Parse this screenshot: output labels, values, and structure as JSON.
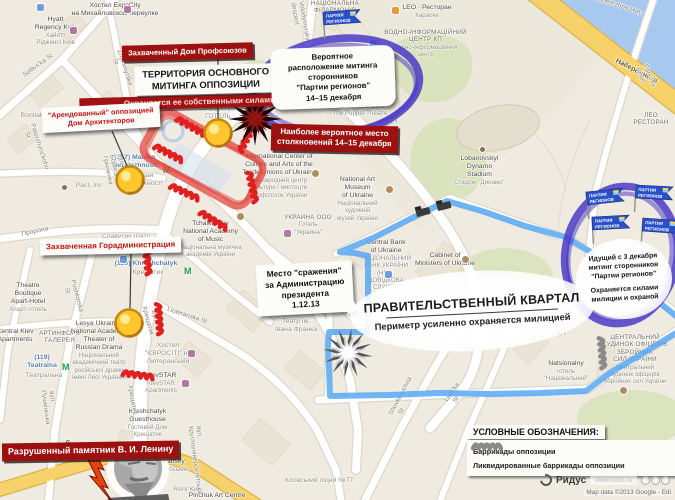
{
  "colors": {
    "barricade_red": "#e02020",
    "barricade_gray": "#8a8a8a",
    "perimeter_blue": "#58a8f4",
    "opposition_zone_red": "#e14038",
    "regions_purple": "#4633c6",
    "flag_blue": "#2a50c8",
    "marker_yellow": "#ffc62e",
    "callout_red_bg": "#9c1110",
    "road_yellow": "#f7d169",
    "water_blue": "#a7c9f0"
  },
  "annotations": {
    "boxes": {
      "trade_union": {
        "text": "Захваченный Дом Профсоюзов"
      },
      "territory": {
        "title_lines": [
          "ТЕРРИТОРИЯ ОСНОВНОГО",
          "МИТИНГА ОППОЗИЦИИ"
        ],
        "sub": "Охраняется ее собственными силами"
      },
      "architects": {
        "lines": [
          "\"Арендованный\" оппозицией",
          "Дом Архитекторов"
        ]
      },
      "rally_probable": {
        "lines": [
          "Вероятное",
          "расположение митинга",
          "сторонников",
          "\"Партии регионов\"",
          "14–15 декабря"
        ]
      },
      "clashes": {
        "lines": [
          "Наиболее вероятное место",
          "столкновений 14–15 декабря"
        ]
      },
      "city_admin": {
        "text": "Захваченная Горадминистрация"
      },
      "battle": {
        "lines": [
          "Место \"сражения\"",
          "за Администрацию",
          "президента",
          "1.12.13"
        ]
      },
      "gov_quarter": {
        "title": "ПРАВИТЕЛЬСТВЕННЫЙ КВАРТАЛ",
        "subtitle": "Периметр усиленно охраняется милицией"
      },
      "regions_rally": {
        "lines": [
          "Идущий с 3 декабря",
          "митинг сторонников",
          "\"Партии регионов\""
        ],
        "sub_lines": [
          "Охраняется силами",
          "милиции и охраной"
        ]
      },
      "lenin": {
        "text": "Разрушенный памятник В. И. Ленину"
      }
    },
    "legend": {
      "title": "УСЛОВНЫЕ ОБОЗНАЧЕНИЯ:",
      "items": [
        {
          "label": "Баррикады оппозиции",
          "color": "#e02020"
        },
        {
          "label": "Ликвидированные баррикады оппозиции",
          "color": "#8a8a8a"
        }
      ]
    },
    "flags_label": "ПАРТИЯ РЕГИОНОВ",
    "flags": [
      {
        "x": 323,
        "y": 12,
        "r": -4
      },
      {
        "x": 586,
        "y": 192,
        "r": -6
      },
      {
        "x": 636,
        "y": 185,
        "r": 3
      },
      {
        "x": 592,
        "y": 217,
        "r": -3
      },
      {
        "x": 643,
        "y": 218,
        "r": 4
      }
    ],
    "markers": [
      {
        "x": 218,
        "y": 133
      },
      {
        "x": 130,
        "y": 180
      },
      {
        "x": 129,
        "y": 323
      }
    ],
    "leaders": [
      [
        218,
        59,
        218,
        120
      ],
      [
        112,
        131,
        128,
        168
      ],
      [
        131,
        254,
        130,
        310
      ]
    ],
    "barricades_red": [
      {
        "x": 190,
        "y": 125,
        "r": 30
      },
      {
        "x": 168,
        "y": 152,
        "r": 28
      },
      {
        "x": 184,
        "y": 191,
        "r": 25
      },
      {
        "x": 213,
        "y": 219,
        "r": 32
      },
      {
        "x": 246,
        "y": 138,
        "r": -62
      },
      {
        "x": 253,
        "y": 186,
        "r": 78
      },
      {
        "x": 148,
        "y": 258,
        "r": 84
      },
      {
        "x": 160,
        "y": 318,
        "r": 86
      },
      {
        "x": 137,
        "y": 374,
        "r": 8
      }
    ],
    "barricades_gray": [
      {
        "x": 603,
        "y": 352,
        "r": 85
      }
    ],
    "vehicles": [
      {
        "x": 423,
        "y": 212,
        "r": -14
      },
      {
        "x": 444,
        "y": 206,
        "r": -14
      }
    ],
    "starbursts": [
      {
        "x": 255,
        "y": 119,
        "k": "dark"
      },
      {
        "x": 348,
        "y": 353,
        "k": "light"
      }
    ]
  },
  "map_labels": [
    {
      "x": 60,
      "y": 2,
      "w": 110,
      "cls": "p",
      "t": [
        "Хостел ExpoCity",
        "на Михайловском переулке"
      ]
    },
    {
      "x": 18,
      "y": 16,
      "w": 75,
      "cls": "p",
      "t": [
        "Hyatt",
        "Regency Kyiv"
      ],
      "s": [
        "Хайятт",
        "Рідженсі Київ"
      ]
    },
    {
      "x": 8,
      "y": 62,
      "w": 60,
      "cls": "st",
      "rot": -36,
      "t": [
        "Sofiivs'ka St"
      ]
    },
    {
      "x": 112,
      "y": 48,
      "w": 20,
      "cls": "st",
      "rot": 72,
      "t": [
        "Mala Zhytomyrska St"
      ]
    },
    {
      "x": 290,
      "y": 2,
      "w": 16,
      "cls": "st",
      "rot": 80,
      "t": [
        "Volodymyrskyi descent"
      ]
    },
    {
      "x": 305,
      "y": 0,
      "w": 60,
      "cls": "caps",
      "t": [
        "НАЦІОНАЛЬНА",
        "ФІЛАРМОНІЯ"
      ]
    },
    {
      "x": 398,
      "y": 4,
      "w": 58,
      "cls": "p",
      "t": [
        "LEO · Ресторан"
      ],
      "s": [
        "Караоке"
      ]
    },
    {
      "x": 378,
      "y": 29,
      "w": 95,
      "cls": "caps",
      "t": [
        "ВОДНО-ІНФОРМАЦІЙНИЙ",
        "ЦЕНТР КП"
      ],
      "s": [
        "Водно-інформаційний",
        "центр"
      ]
    },
    {
      "x": 588,
      "y": 2,
      "w": 60,
      "cls": "st",
      "rot": 18,
      "t": [
        "Naberezhne Hwy"
      ]
    },
    {
      "x": 606,
      "y": 68,
      "w": 62,
      "cls": "sty",
      "rot": 27,
      "t": [
        "Набережне ш."
      ]
    },
    {
      "x": 636,
      "y": 66,
      "w": 16,
      "cls": "st",
      "rot": 68,
      "t": [
        "Parkova Road"
      ]
    },
    {
      "x": 626,
      "y": 112,
      "w": 50,
      "cls": "caps",
      "t": [
        "ЛЕО",
        "РЕСТОРАН"
      ]
    },
    {
      "x": 325,
      "y": 88,
      "w": 70,
      "cls": "caps",
      "t": [
        "КИЇВСЬКИЙ",
        "АКАДЕМІЧНИЙ",
        "ТЕАТР ЛЯЛЬОК"
      ],
      "s": [
        "The Puppet Theatre"
      ]
    },
    {
      "x": 348,
      "y": 126,
      "w": 60,
      "cls": "st",
      "rot": -27,
      "t": [
        "Petrivs'ka alley"
      ]
    },
    {
      "x": 452,
      "y": 155,
      "w": 55,
      "cls": "p",
      "t": [
        "Lobanovskyi",
        "Dynamo",
        "Stadium"
      ],
      "s": [
        "Стадіон \"Динамо\""
      ]
    },
    {
      "x": 100,
      "y": 154,
      "w": 70,
      "cls": "tr",
      "t": [
        "(217) Maidan",
        "Nezalezhnosti"
      ]
    },
    {
      "x": 112,
      "y": 172,
      "w": 58,
      "cls": "g",
      "t": [
        "Майдан",
        "Незалежності"
      ]
    },
    {
      "x": 238,
      "y": 153,
      "w": 82,
      "cls": "p",
      "t": [
        "International Center of",
        "Culture and Arts of the",
        "Trade Unions of Ukraine"
      ],
      "s": [
        "Міжнародний центр",
        "культури і мистецтв",
        "профспілок України"
      ]
    },
    {
      "x": 282,
      "y": 214,
      "w": 52,
      "cls": "caps",
      "t": [
        "УКРАИНА ООО"
      ],
      "s": [
        "Готель",
        "\"Украина\""
      ]
    },
    {
      "x": 168,
      "y": 220,
      "w": 85,
      "cls": "p",
      "t": [
        "Tchaikovsky",
        "National Academy",
        "of Music"
      ],
      "s": [
        "Національна музична",
        "академія України"
      ]
    },
    {
      "x": 330,
      "y": 176,
      "w": 55,
      "cls": "p",
      "t": [
        "National Art",
        "Museum",
        "of Ukraine"
      ],
      "s": [
        "Національний",
        "художній",
        "музей України"
      ]
    },
    {
      "x": 355,
      "y": 239,
      "w": 62,
      "cls": "p",
      "t": [
        "Central Bank",
        "of Ukraine"
      ],
      "s": [
        "НАЦІОНАЛЬНИЙ",
        "БАНК УКРАЇНИ (НБУ),",
        "ДОВІДКОВА СЛУЖБА"
      ]
    },
    {
      "x": 414,
      "y": 252,
      "w": 62,
      "cls": "p",
      "t": [
        "Cabinet of",
        "Ministers of Ukraine"
      ]
    },
    {
      "x": 95,
      "y": 233,
      "w": 62,
      "cls": "g",
      "t": [
        "Славутич Шато",
        "пивоварня"
      ]
    },
    {
      "x": 110,
      "y": 260,
      "w": 72,
      "cls": "tr",
      "t": [
        "(120) Khreshchatyk"
      ]
    },
    {
      "x": 128,
      "y": 269,
      "w": 40,
      "cls": "g",
      "t": [
        "Крещатик"
      ]
    },
    {
      "x": 4,
      "y": 282,
      "w": 48,
      "cls": "p",
      "t": [
        "Theatre",
        "Boutique",
        "Apart-Hotel"
      ],
      "s": [
        "Апарт-готель"
      ]
    },
    {
      "x": 62,
      "y": 282,
      "w": 18,
      "cls": "st",
      "rot": 75,
      "t": [
        "Pushkinska St"
      ]
    },
    {
      "x": 40,
      "y": 390,
      "w": 16,
      "cls": "st",
      "rot": 82,
      "t": [
        "вул. Пушкінська"
      ]
    },
    {
      "x": 10,
      "y": 228,
      "w": 50,
      "cls": "st",
      "rot": -12,
      "t": [
        "Прорізна"
      ]
    },
    {
      "x": 272,
      "y": 318,
      "w": 48,
      "cls": "g",
      "t": [
        "Театр ім.",
        "Івана Франка"
      ]
    },
    {
      "x": -8,
      "y": 328,
      "w": 46,
      "cls": "p",
      "t": [
        "Central Kiev",
        "Apartments"
      ]
    },
    {
      "x": 36,
      "y": 330,
      "w": 48,
      "cls": "caps",
      "t": [
        "АРТИНФОРМ",
        "ГАЛЕРЕЯ"
      ]
    },
    {
      "x": 70,
      "y": 320,
      "w": 58,
      "cls": "p",
      "t": [
        "Lesya Ukrainka",
        "National Academic",
        "Theater of",
        "Russian Drama"
      ],
      "s": [
        "Національний",
        "академічний театр",
        "російської драми",
        "імені Лесі Українки"
      ]
    },
    {
      "x": 20,
      "y": 354,
      "w": 44,
      "cls": "tr",
      "t": [
        "(119)",
        "Teatralna"
      ]
    },
    {
      "x": 22,
      "y": 372,
      "w": 44,
      "cls": "g",
      "t": [
        "Театральна"
      ]
    },
    {
      "x": 142,
      "y": 342,
      "w": 52,
      "cls": "g",
      "t": [
        "Хостел",
        "\"ЄВРОСІТІ\" на",
        "Лютеранській"
      ]
    },
    {
      "x": 138,
      "y": 372,
      "w": 46,
      "cls": "p",
      "t": [
        "KievSTAR"
      ],
      "s": [
        "KievSTAR",
        "Apartments"
      ]
    },
    {
      "x": 158,
      "y": 312,
      "w": 58,
      "cls": "st",
      "rot": 18,
      "t": [
        "Liuteranska St"
      ]
    },
    {
      "x": 120,
      "y": 408,
      "w": 55,
      "cls": "p",
      "t": [
        "Kreshchatyk",
        "Guesthouse"
      ],
      "s": [
        "Гостевой Дом",
        "Крещатик"
      ]
    },
    {
      "x": 142,
      "y": 458,
      "w": 50,
      "cls": "p",
      "t": [
        "Besarabsky"
      ],
      "s": [
        "Бессарабський"
      ]
    },
    {
      "x": 168,
      "y": 486,
      "w": 40,
      "cls": "g",
      "t": [
        "Rent Kiev"
      ]
    },
    {
      "x": 186,
      "y": 492,
      "w": 62,
      "cls": "p",
      "t": [
        "Pinchuk Art Centre"
      ]
    },
    {
      "x": 55,
      "y": 448,
      "w": 95,
      "cls": "sty",
      "rot": 13,
      "t": [
        "бул. Тараса Шевченка"
      ]
    },
    {
      "x": 390,
      "y": 402,
      "w": 16,
      "cls": "st",
      "rot": -62,
      "t": [
        "Shovkovychna St"
      ]
    },
    {
      "x": 446,
      "y": 390,
      "w": 14,
      "cls": "st",
      "rot": -55,
      "t": [
        "Lyps'ka St"
      ]
    },
    {
      "x": 596,
      "y": 334,
      "w": 78,
      "cls": "caps",
      "t": [
        "ЦЕНТРАЛЬНИЙ",
        "БУДИНОК ОФІЦЕРІВ",
        "ЗБРОЙНИХ",
        "СИЛ УКРАЇНИ"
      ],
      "s": [
        "Центральний",
        "будинок офіцерів",
        "Збройних сил України"
      ]
    },
    {
      "x": 540,
      "y": 360,
      "w": 52,
      "cls": "p",
      "t": [
        "Natsionalny"
      ],
      "s": [
        "готель",
        "\"Національний\""
      ]
    },
    {
      "x": 424,
      "y": 328,
      "w": 42,
      "cls": "g caps",
      "t": [
        "КАВ'ЯРНЯ"
      ]
    },
    {
      "x": 524,
      "y": 323,
      "w": 46,
      "cls": "g caps",
      "t": [
        "КИЇВ",
        "ГОТЕЛЬ ДП"
      ]
    },
    {
      "x": 280,
      "y": 477,
      "w": 78,
      "cls": "g",
      "t": [
        "Кловський ліцей №77"
      ]
    },
    {
      "x": 12,
      "y": 112,
      "w": 40,
      "cls": "g",
      "t": [
        "Bontiak"
      ]
    },
    {
      "x": 68,
      "y": 182,
      "w": 42,
      "cls": "g",
      "t": [
        "Pact, Inc"
      ]
    },
    {
      "x": 22,
      "y": 126,
      "w": 18,
      "cls": "st",
      "rot": 72,
      "t": [
        "Patorzhyns'koho St"
      ]
    },
    {
      "x": 106,
      "y": 150,
      "w": 14,
      "cls": "st",
      "rot": 78,
      "t": [
        "вул. Бориса Грінченка"
      ]
    },
    {
      "x": 192,
      "y": 106,
      "w": 52,
      "cls": "g caps",
      "t": [
        "ХРЕЩАТИК",
        "ГОТЕЛЬ"
      ]
    },
    {
      "x": 138,
      "y": 310,
      "w": 26,
      "cls": "st",
      "rot": 75,
      "t": [
        "Вул. Хрещатик"
      ]
    },
    {
      "x": 122,
      "y": 390,
      "w": 18,
      "cls": "st",
      "rot": 80,
      "t": [
        "Хрещатик"
      ]
    },
    {
      "x": 188,
      "y": 425,
      "w": 14,
      "cls": "st",
      "rot": 82,
      "t": [
        "вул. Круглоуніверситетська"
      ]
    }
  ],
  "map_icons": [
    {
      "x": 37,
      "y": 4,
      "k": "info"
    },
    {
      "x": 70,
      "y": 27,
      "k": "bed"
    },
    {
      "x": 124,
      "y": 6,
      "k": "bed"
    },
    {
      "x": 392,
      "y": 7,
      "k": "food"
    },
    {
      "x": 370,
      "y": 40,
      "k": "info"
    },
    {
      "x": 480,
      "y": 147,
      "k": "dot"
    },
    {
      "x": 163,
      "y": 165,
      "k": "metro"
    },
    {
      "x": 184,
      "y": 266,
      "k": "metro"
    },
    {
      "x": 62,
      "y": 362,
      "k": "metro"
    },
    {
      "x": 312,
      "y": 170,
      "k": "poi"
    },
    {
      "x": 237,
      "y": 213,
      "k": "poi"
    },
    {
      "x": 386,
      "y": 186,
      "k": "poi"
    },
    {
      "x": 385,
      "y": 271,
      "k": "info"
    },
    {
      "x": 462,
      "y": 256,
      "k": "poi"
    },
    {
      "x": 160,
      "y": 238,
      "k": "food"
    },
    {
      "x": 188,
      "y": 350,
      "k": "bed"
    },
    {
      "x": 182,
      "y": 380,
      "k": "bed"
    },
    {
      "x": 620,
      "y": 387,
      "k": "poi"
    },
    {
      "x": 62,
      "y": 185,
      "k": "dot"
    },
    {
      "x": 120,
      "y": 256,
      "k": "info"
    },
    {
      "x": 284,
      "y": 230,
      "k": "bed"
    }
  ],
  "attribution": {
    "brand": "Ридус",
    "watermark": "www.ridus.ru",
    "map_data": "Map data ©2013 Google -  Edi"
  }
}
